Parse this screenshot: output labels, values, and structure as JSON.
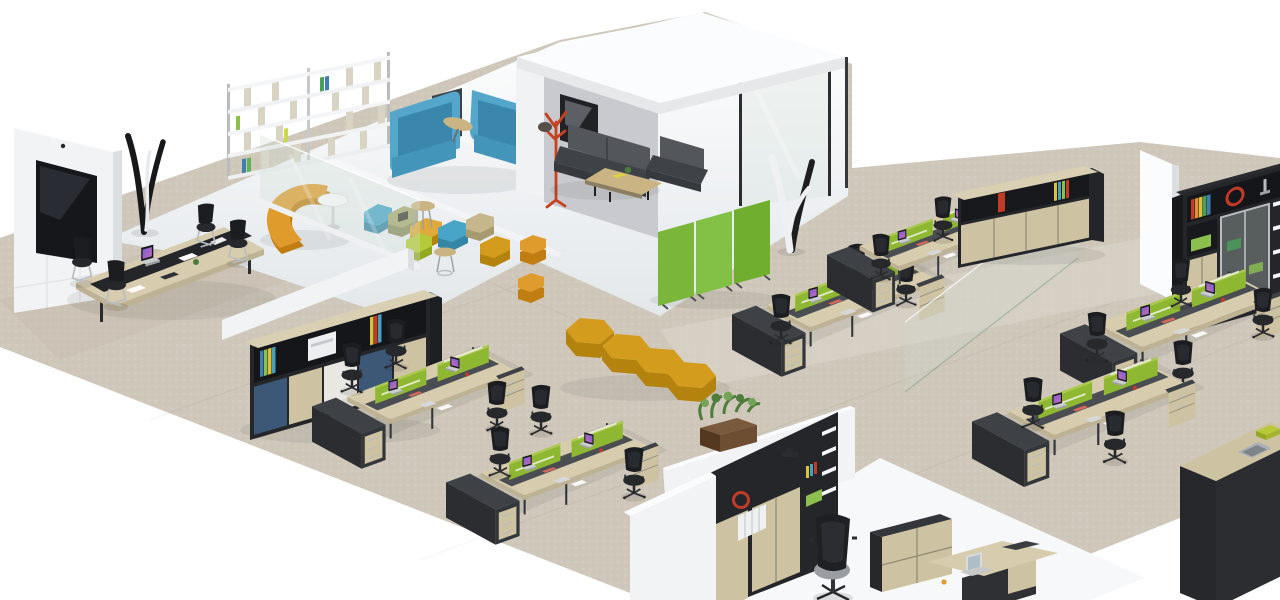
{
  "meta": {
    "title": "Isometric 3D rendering of an open-plan office interior",
    "type": "3d-render"
  },
  "canvas": {
    "width": 1280,
    "height": 600
  },
  "palette": {
    "bg": "#ffffff",
    "carpet": "#cfc7ba",
    "carpetLight": "#dbd4c9",
    "carpetDark": "#c2b9ac",
    "loungeA": "#ffffff",
    "loungeB": "#e4e8ea",
    "officeFloor": "#f7f8f9",
    "wallWhite": "#f2f3f5",
    "wallBright": "#fbfcfd",
    "wallShade": "#dcdfe2",
    "podWallInner": "#c8cacf",
    "roofWhite": "#fbfcfd",
    "roofEdge": "#e6e8ea",
    "screenGreen": "#8fb832",
    "screenGreenLight": "#aac94d",
    "partitionGreen": "#79b63a",
    "partitionGreenB": "#83c046",
    "partitionGreenC": "#6fae2e",
    "deskWood": "#d7cdae",
    "deskWoodDark": "#bdb294",
    "deskCharcoal": "#3e4146",
    "deskCharcoalDark": "#2b2d31",
    "spineGray": "#4a4d52",
    "cabinetWood": "#cdc3a3",
    "cabinetBlue": "#3d5877",
    "panelWhite": "#e9e7e1",
    "frameDark": "#24262a",
    "chairBlack": "#1b1d20",
    "chairMid": "#26282b",
    "chairGray": "#9a9da2",
    "metalSilver": "#b9bdc1",
    "sofaGray": "#53565b",
    "sofaGrayDark": "#3f4246",
    "sofaBlue": "#54a6ca",
    "sofaBlueDark": "#3a87ab",
    "boothPanel": "#3f4247",
    "orange": "#e09b2d",
    "orangeDark": "#c07e12",
    "mustard": "#d49c1c",
    "mustardDark": "#b3830e",
    "lime": "#b6ca39",
    "khaki": "#c6b68c",
    "khakiDark": "#a89a6f",
    "olive": "#a8a873",
    "oliveDark": "#8d8d5c",
    "tealPouf": "#48a5c8",
    "tealPoufDark": "#3585a6",
    "red": "#c23b28",
    "plantGreen": "#4e7c3a",
    "plantGreenLight": "#74a355",
    "woodBrown": "#6d4e33",
    "woodBrownDark": "#54381f",
    "tableWood": "#cbb484",
    "glassTint": "#cfe0d8",
    "glassEdge": "#9ab0a8",
    "screenDark": "#15171a",
    "white": "#ffffff"
  },
  "scene": {
    "areas": [
      {
        "id": "lounge",
        "objects": [
          "white-bookshelf",
          "blue-booth-sofas",
          "orange-curved-bench",
          "white-round-table",
          "modular-pouf-chain",
          "hex-stools",
          "wood-side-tables",
          "glass-screen"
        ]
      },
      {
        "id": "meeting-pod",
        "objects": [
          "white-cube-roof",
          "grey-sofa",
          "grey-armchair",
          "wood-coffee-table",
          "wall-picture",
          "red-coat-stand",
          "glass-wall"
        ]
      },
      {
        "id": "conference-corner",
        "objects": [
          "media-wall",
          "tv-screen",
          "black-coat-tree",
          "conference-table",
          "cantilever-chairs",
          "laptop"
        ]
      },
      {
        "id": "open-work-left",
        "objects": [
          "low-white-wall",
          "storage-credenza",
          "printer",
          "bench-desks",
          "green-desk-screens",
          "task-chairs",
          "laptops"
        ]
      },
      {
        "id": "open-work-center",
        "objects": [
          "green-floor-partition",
          "white-coat-tree",
          "yellow-zigzag-bench",
          "bench-desks",
          "glass-screen"
        ]
      },
      {
        "id": "open-work-right",
        "objects": [
          "storage-cabinets",
          "white-wall",
          "tall-bookcase",
          "bench-desks",
          "service-counter"
        ]
      },
      {
        "id": "private-office",
        "objects": [
          "white-walls",
          "planter-box",
          "dark-bookcase",
          "executive-chair",
          "side-cabinet",
          "executive-desk",
          "silver-laptop"
        ]
      }
    ]
  }
}
